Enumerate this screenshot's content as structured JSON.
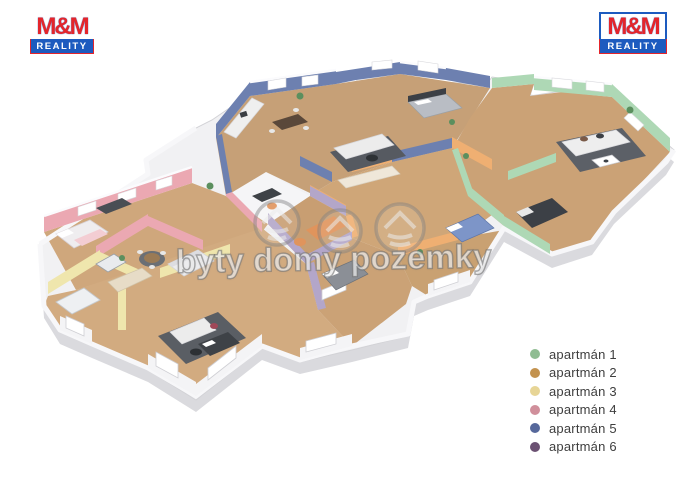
{
  "branding": {
    "name": "M&M",
    "subtitle": "REALITY",
    "name_color": "#e4252b",
    "banner_color": "#1d5bbf"
  },
  "watermark": {
    "text": "byty domy pozemky",
    "icon": "house-in-circle-icon"
  },
  "legend": {
    "items": [
      {
        "label": "apartmán 1",
        "color": "#8fbc92"
      },
      {
        "label": "apartmán 2",
        "color": "#c3924e"
      },
      {
        "label": "apartmán 3",
        "color": "#e7d596"
      },
      {
        "label": "apartmán 4",
        "color": "#d08f9b"
      },
      {
        "label": "apartmán 5",
        "color": "#56689b"
      },
      {
        "label": "apartmán 6",
        "color": "#6b5172"
      }
    ]
  },
  "plan": {
    "type": "3d-isometric-floor-plan",
    "apartments_count": 6,
    "wall_colors": {
      "apartment1_green": "#aed8b5",
      "apartment2_orange": "#efaf72",
      "apartment3_yellow": "#efe6ad",
      "apartment4_pink": "#eba8b2",
      "apartment5_blue": "#6d80b0",
      "apartment6_purple": "#b3a6c9",
      "outer_white": "#f4f4f6"
    },
    "floor_color": "#cda57a",
    "rug_color": "#565a61",
    "base_color": "#e3e3e7"
  }
}
